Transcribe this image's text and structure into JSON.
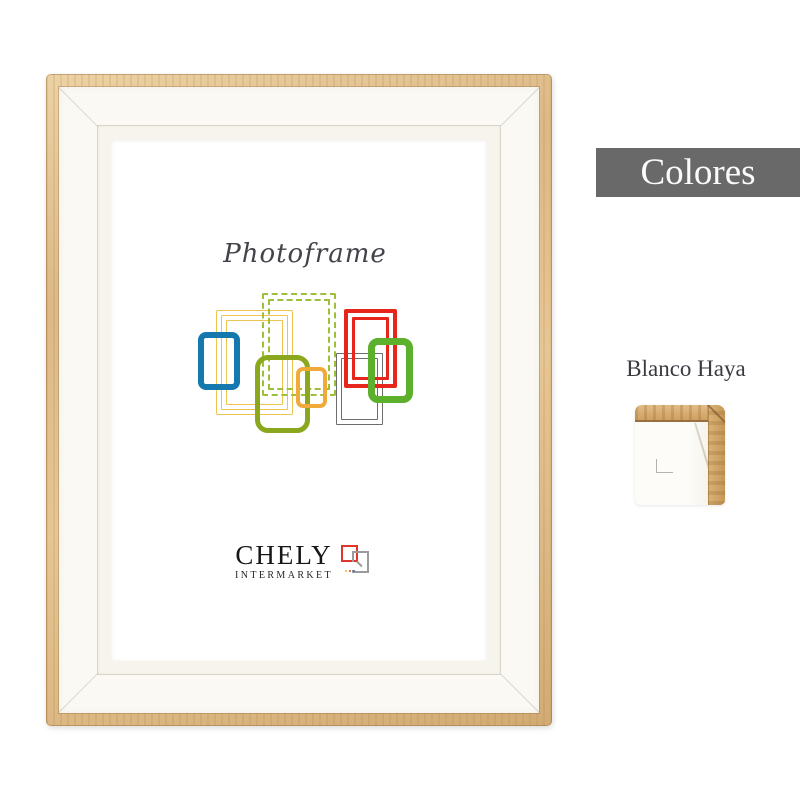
{
  "product": {
    "frame": {
      "description": "white photo frame with natural wood edge",
      "wood_color": "#dcb987",
      "mat_color": "#fbf9f4",
      "art": {
        "title": "Photoframe",
        "title_color": "#43434b",
        "brand": {
          "name": "CHELY",
          "subtitle": "INTERMARKET"
        },
        "logo_mark": {
          "red_square_color": "#e2362c",
          "gray_square_color": "#9b9b9b",
          "dot_colors": [
            "#eebd2e",
            "#cf4a3e",
            "#3f66bd"
          ]
        },
        "artwork_frames": [
          {
            "name": "yellow-triple-frame",
            "color": "#ecc551",
            "x": 19,
            "y": 17,
            "w": 77,
            "h": 105,
            "radius": 2,
            "layers": [
              {
                "inset": 0,
                "b": 1.6
              },
              {
                "inset": 5,
                "b": 1.6
              },
              {
                "inset": 10,
                "b": 1.6
              }
            ]
          },
          {
            "name": "green-dashed-frame",
            "color": "#9dbf3a",
            "x": 65,
            "y": 0,
            "w": 74,
            "h": 103,
            "radius": 2,
            "dashed": true,
            "layers": [
              {
                "inset": 0,
                "b": 2
              },
              {
                "inset": 6,
                "b": 2
              }
            ]
          },
          {
            "name": "blue-frame",
            "color": "#1579ad",
            "x": 1,
            "y": 39,
            "w": 42,
            "h": 58,
            "radius": 8,
            "layers": [
              {
                "inset": 0,
                "b": 6.5
              }
            ]
          },
          {
            "name": "olive-frame",
            "color": "#8aa71e",
            "x": 58,
            "y": 62,
            "w": 55,
            "h": 78,
            "radius": 13,
            "layers": [
              {
                "inset": 0,
                "b": 5.5
              }
            ]
          },
          {
            "name": "orange-frame",
            "color": "#f1a93a",
            "x": 99,
            "y": 74,
            "w": 31,
            "h": 41,
            "radius": 7,
            "layers": [
              {
                "inset": 0,
                "b": 4
              }
            ]
          },
          {
            "name": "gray-double-frame",
            "color": "#6d6d6d",
            "x": 139,
            "y": 60,
            "w": 47,
            "h": 72,
            "radius": 1,
            "layers": [
              {
                "inset": 0,
                "b": 1.6
              },
              {
                "inset": 5,
                "b": 1.6
              }
            ]
          },
          {
            "name": "red-double-frame",
            "color": "#e6261d",
            "x": 147,
            "y": 16,
            "w": 53,
            "h": 79,
            "radius": 2,
            "layers": [
              {
                "inset": 0,
                "b": 4
              },
              {
                "inset": 8,
                "b": 3.5
              }
            ]
          },
          {
            "name": "green-bright-frame",
            "color": "#5db02c",
            "x": 171,
            "y": 45,
            "w": 45,
            "h": 65,
            "radius": 10,
            "layers": [
              {
                "inset": 0,
                "b": 7
              }
            ]
          }
        ]
      }
    }
  },
  "side_panel": {
    "banner": {
      "label": "Colores",
      "bg_color": "#696969",
      "text_color": "#fbfbfb"
    },
    "swatch": {
      "label": "Blanco Haya",
      "wood_color": "#cfa062",
      "face_color": "#fdfcf8"
    }
  }
}
